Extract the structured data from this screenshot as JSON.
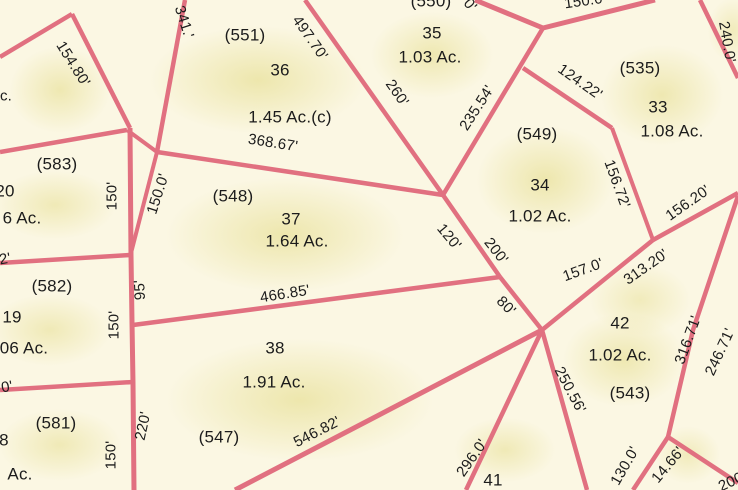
{
  "map": {
    "type": "cadastral-parcel-map",
    "colors": {
      "background": "#fbf7e3",
      "parcel_fill_tint": "#e2d980",
      "boundary_line": "#e17080",
      "label_text": "#1c1c1c"
    },
    "parcels": [
      {
        "id": "(551)",
        "lot": "36",
        "acreage": "1.45 Ac.(c)"
      },
      {
        "id": "(550)",
        "lot": "35",
        "acreage": "1.03 Ac."
      },
      {
        "id": "(535)",
        "lot": "33",
        "acreage": "1.08 Ac."
      },
      {
        "id": "(549)",
        "lot": "34",
        "acreage": "1.02 Ac."
      },
      {
        "id": "(548)",
        "lot": "37",
        "acreage": "1.64 Ac."
      },
      {
        "id": "(547)",
        "lot": "38",
        "acreage": "1.91 Ac."
      },
      {
        "id": "(543)",
        "lot": "42",
        "acreage": "1.02 Ac."
      },
      {
        "id": "",
        "lot": "41",
        "acreage": ""
      },
      {
        "id": "(583)",
        "lot": "20",
        "acreage": "6 Ac."
      },
      {
        "id": "(582)",
        "lot": "19",
        "acreage": "06 Ac."
      },
      {
        "id": "(581)",
        "lot": "8",
        "acreage": "Ac."
      }
    ],
    "labels": [
      {
        "text": "(551)",
        "kind": "parcel-id",
        "x": 245,
        "y": 35,
        "rot": 0
      },
      {
        "text": "36",
        "kind": "lot-number",
        "x": 280,
        "y": 70,
        "rot": 0
      },
      {
        "text": "1.45 Ac.(c)",
        "kind": "acreage",
        "x": 290,
        "y": 117,
        "rot": 0
      },
      {
        "text": "(550)",
        "kind": "parcel-id",
        "x": 431,
        "y": 1,
        "rot": 0
      },
      {
        "text": "35",
        "kind": "lot-number",
        "x": 432,
        "y": 33,
        "rot": 0
      },
      {
        "text": "1.03 Ac.",
        "kind": "acreage",
        "x": 430,
        "y": 57,
        "rot": 0
      },
      {
        "text": "(535)",
        "kind": "parcel-id",
        "x": 640,
        "y": 68,
        "rot": 0
      },
      {
        "text": "33",
        "kind": "lot-number",
        "x": 658,
        "y": 107,
        "rot": 0
      },
      {
        "text": "1.08 Ac.",
        "kind": "acreage",
        "x": 672,
        "y": 131,
        "rot": 0
      },
      {
        "text": "(549)",
        "kind": "parcel-id",
        "x": 537,
        "y": 134,
        "rot": 0
      },
      {
        "text": "34",
        "kind": "lot-number",
        "x": 540,
        "y": 185,
        "rot": 0
      },
      {
        "text": "1.02 Ac.",
        "kind": "acreage",
        "x": 540,
        "y": 216,
        "rot": 0
      },
      {
        "text": "(548)",
        "kind": "parcel-id",
        "x": 233,
        "y": 196,
        "rot": 0
      },
      {
        "text": "37",
        "kind": "lot-number",
        "x": 291,
        "y": 219,
        "rot": 0
      },
      {
        "text": "1.64 Ac.",
        "kind": "acreage",
        "x": 297,
        "y": 241,
        "rot": 0
      },
      {
        "text": "38",
        "kind": "lot-number",
        "x": 275,
        "y": 348,
        "rot": 0
      },
      {
        "text": "1.91 Ac.",
        "kind": "acreage",
        "x": 274,
        "y": 382,
        "rot": 0
      },
      {
        "text": "(547)",
        "kind": "parcel-id",
        "x": 219,
        "y": 437,
        "rot": 0
      },
      {
        "text": "42",
        "kind": "lot-number",
        "x": 620,
        "y": 323,
        "rot": 0
      },
      {
        "text": "1.02 Ac.",
        "kind": "acreage",
        "x": 620,
        "y": 355,
        "rot": 0
      },
      {
        "text": "(543)",
        "kind": "parcel-id",
        "x": 630,
        "y": 393,
        "rot": 0
      },
      {
        "text": "41",
        "kind": "lot-number",
        "x": 493,
        "y": 480,
        "rot": 0
      },
      {
        "text": "(583)",
        "kind": "parcel-id",
        "x": 57,
        "y": 164,
        "rot": 0
      },
      {
        "text": "20",
        "kind": "lot-number",
        "x": 5,
        "y": 191,
        "rot": 0
      },
      {
        "text": "6 Ac.",
        "kind": "acreage",
        "x": 22,
        "y": 218,
        "rot": 0
      },
      {
        "text": "(582)",
        "kind": "parcel-id",
        "x": 52,
        "y": 286,
        "rot": 0
      },
      {
        "text": "19",
        "kind": "lot-number",
        "x": 12,
        "y": 317,
        "rot": 0
      },
      {
        "text": "06 Ac.",
        "kind": "acreage",
        "x": 24,
        "y": 348,
        "rot": 0
      },
      {
        "text": "(581)",
        "kind": "parcel-id",
        "x": 56,
        "y": 423,
        "rot": 0
      },
      {
        "text": "8",
        "kind": "lot-number",
        "x": 4,
        "y": 440,
        "rot": 0
      },
      {
        "text": "Ac.",
        "kind": "acreage",
        "x": 20,
        "y": 474,
        "rot": 0
      },
      {
        "text": "c.",
        "kind": "fragment",
        "x": 6,
        "y": 96,
        "rot": 0
      },
      {
        "text": "154.80'",
        "kind": "dimension",
        "x": 73,
        "y": 64,
        "rot": 58
      },
      {
        "text": "341.'",
        "kind": "dimension",
        "x": 184,
        "y": 22,
        "rot": 72
      },
      {
        "text": "497.70'",
        "kind": "dimension",
        "x": 310,
        "y": 38,
        "rot": 55
      },
      {
        "text": "260'",
        "kind": "dimension",
        "x": 397,
        "y": 93,
        "rot": 55
      },
      {
        "text": "235.54'",
        "kind": "dimension",
        "x": 477,
        "y": 108,
        "rot": -57
      },
      {
        "text": "124.22'",
        "kind": "dimension",
        "x": 580,
        "y": 82,
        "rot": 35
      },
      {
        "text": "156.72'",
        "kind": "dimension",
        "x": 617,
        "y": 184,
        "rot": 70
      },
      {
        "text": "156.20'",
        "kind": "dimension",
        "x": 688,
        "y": 203,
        "rot": -35
      },
      {
        "text": "240.0'",
        "kind": "dimension",
        "x": 727,
        "y": 42,
        "rot": 80
      },
      {
        "text": "150.0'",
        "kind": "dimension",
        "x": 585,
        "y": 1,
        "rot": -8
      },
      {
        "text": "0'",
        "kind": "dimension",
        "x": 470,
        "y": 5,
        "rot": 50
      },
      {
        "text": "150.0'",
        "kind": "dimension",
        "x": 158,
        "y": 194,
        "rot": -72
      },
      {
        "text": "150'",
        "kind": "dimension",
        "x": 112,
        "y": 196,
        "rot": -90
      },
      {
        "text": "95'",
        "kind": "dimension",
        "x": 140,
        "y": 290,
        "rot": -93
      },
      {
        "text": "150'",
        "kind": "dimension",
        "x": 114,
        "y": 325,
        "rot": -90
      },
      {
        "text": "2'",
        "kind": "dimension",
        "x": 5,
        "y": 259,
        "rot": -10
      },
      {
        "text": "0'",
        "kind": "dimension",
        "x": 7,
        "y": 387,
        "rot": -10
      },
      {
        "text": "150'",
        "kind": "dimension",
        "x": 111,
        "y": 455,
        "rot": -90
      },
      {
        "text": "220'",
        "kind": "dimension",
        "x": 143,
        "y": 426,
        "rot": -78
      },
      {
        "text": "368.67'",
        "kind": "dimension",
        "x": 273,
        "y": 143,
        "rot": 9
      },
      {
        "text": "466.85'",
        "kind": "dimension",
        "x": 285,
        "y": 294,
        "rot": -9
      },
      {
        "text": "120'",
        "kind": "dimension",
        "x": 449,
        "y": 237,
        "rot": 50
      },
      {
        "text": "200'",
        "kind": "dimension",
        "x": 496,
        "y": 251,
        "rot": 52
      },
      {
        "text": "80'",
        "kind": "dimension",
        "x": 506,
        "y": 306,
        "rot": 45
      },
      {
        "text": "157.0'",
        "kind": "dimension",
        "x": 583,
        "y": 270,
        "rot": -20
      },
      {
        "text": "313.20'",
        "kind": "dimension",
        "x": 646,
        "y": 267,
        "rot": -35
      },
      {
        "text": "546.82'",
        "kind": "dimension",
        "x": 317,
        "y": 432,
        "rot": -27
      },
      {
        "text": "296.0'",
        "kind": "dimension",
        "x": 472,
        "y": 458,
        "rot": -55
      },
      {
        "text": "250.56'",
        "kind": "dimension",
        "x": 570,
        "y": 390,
        "rot": 62
      },
      {
        "text": "130.0'",
        "kind": "dimension",
        "x": 625,
        "y": 466,
        "rot": -60
      },
      {
        "text": "14.66'",
        "kind": "dimension",
        "x": 668,
        "y": 465,
        "rot": -50
      },
      {
        "text": "316.71'",
        "kind": "dimension",
        "x": 688,
        "y": 340,
        "rot": -70
      },
      {
        "text": "246.71'",
        "kind": "dimension",
        "x": 720,
        "y": 352,
        "rot": -65
      },
      {
        "text": "200",
        "kind": "fragment",
        "x": 731,
        "y": 482,
        "rot": -25
      }
    ],
    "boundary_lines": [
      {
        "points": "0,57 72,14",
        "w": 4.5
      },
      {
        "points": "72,14 130,128",
        "w": 4.5
      },
      {
        "points": "0,152 127,130",
        "w": 4.5
      },
      {
        "points": "130,128 131,255 132,322 133,383 134,490",
        "w": 5
      },
      {
        "points": "0,263 130,255",
        "w": 4.5
      },
      {
        "points": "0,390 133,382",
        "w": 4.5
      },
      {
        "points": "133,325 500,277",
        "w": 4.5
      },
      {
        "points": "127,130 157,152",
        "w": 4
      },
      {
        "points": "185,0 157,152",
        "w": 4.5
      },
      {
        "points": "157,152 130,257",
        "w": 4
      },
      {
        "points": "157,152 443,195",
        "w": 4.5
      },
      {
        "points": "305,0 443,195",
        "w": 4.5
      },
      {
        "points": "543,28 443,195",
        "w": 4.5
      },
      {
        "points": "475,0 543,28",
        "w": 5
      },
      {
        "points": "543,28 655,0",
        "w": 5
      },
      {
        "points": "523,68 612,128",
        "w": 4.5
      },
      {
        "points": "612,128 653,240",
        "w": 4
      },
      {
        "points": "700,0 738,78",
        "w": 4.5
      },
      {
        "points": "738,193 653,240",
        "w": 4.5
      },
      {
        "points": "653,240 542,330",
        "w": 4.5
      },
      {
        "points": "443,195 500,277",
        "w": 4.5
      },
      {
        "points": "500,277 542,330",
        "w": 4.5
      },
      {
        "points": "542,330 235,490",
        "w": 5
      },
      {
        "points": "542,330 466,490",
        "w": 4.5
      },
      {
        "points": "542,330 587,490",
        "w": 4.5
      },
      {
        "points": "738,196 693,330 668,437",
        "w": 4.5
      },
      {
        "points": "668,437 633,490",
        "w": 4.5
      },
      {
        "points": "668,437 738,483",
        "w": 4.5
      }
    ]
  }
}
